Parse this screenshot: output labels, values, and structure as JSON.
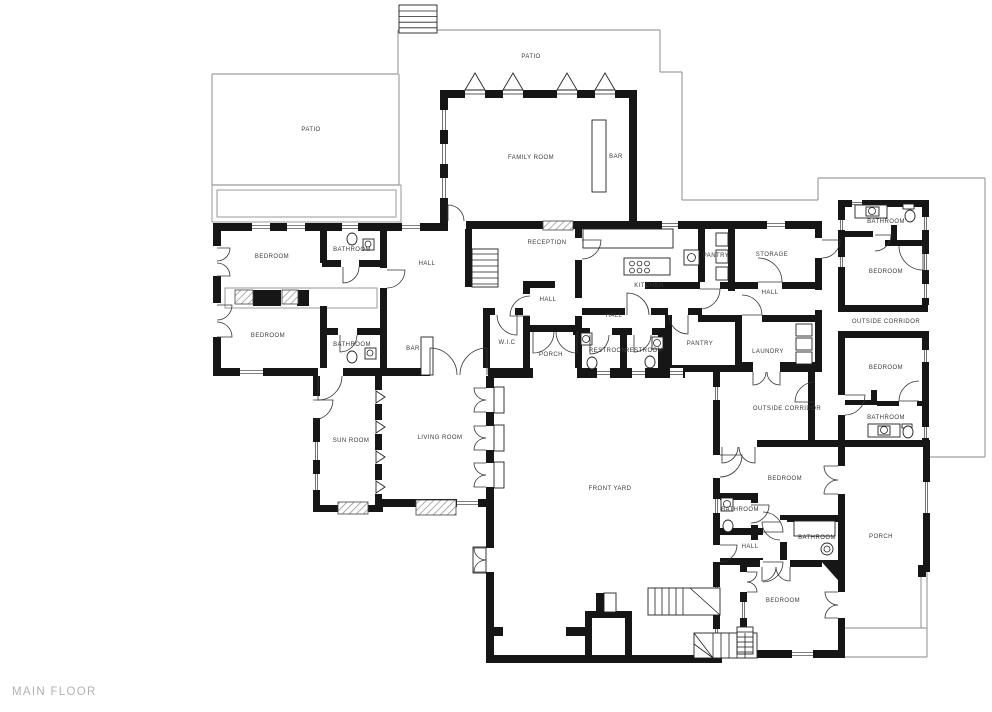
{
  "plan": {
    "title": "MAIN FLOOR",
    "rooms": [
      {
        "label": "PATIO",
        "x": 531,
        "y": 57
      },
      {
        "label": "PATIO",
        "x": 311,
        "y": 130
      },
      {
        "label": "FAMILY ROOM",
        "x": 531,
        "y": 158
      },
      {
        "label": "BAR",
        "x": 616,
        "y": 157
      },
      {
        "label": "BEDROOM",
        "x": 272,
        "y": 257
      },
      {
        "label": "BATHROOM",
        "x": 352,
        "y": 250
      },
      {
        "label": "HALL",
        "x": 427,
        "y": 264
      },
      {
        "label": "RECEPTION",
        "x": 547,
        "y": 243
      },
      {
        "label": "KITCHEN",
        "x": 649,
        "y": 286
      },
      {
        "label": "PANTRY",
        "x": 716,
        "y": 256
      },
      {
        "label": "STORAGE",
        "x": 772,
        "y": 255
      },
      {
        "label": "HALL",
        "x": 770,
        "y": 293
      },
      {
        "label": "BATHROOM",
        "x": 886,
        "y": 222
      },
      {
        "label": "BEDROOM",
        "x": 886,
        "y": 272
      },
      {
        "label": "OUTSIDE CORRIDOR",
        "x": 886,
        "y": 322
      },
      {
        "label": "BEDROOM",
        "x": 268,
        "y": 336
      },
      {
        "label": "BATHROOM",
        "x": 352,
        "y": 345
      },
      {
        "label": "BAR",
        "x": 413,
        "y": 349
      },
      {
        "label": "W.I.C",
        "x": 507,
        "y": 343
      },
      {
        "label": "HALL",
        "x": 548,
        "y": 300
      },
      {
        "label": "HALL",
        "x": 614,
        "y": 316
      },
      {
        "label": "PORCH",
        "x": 551,
        "y": 355
      },
      {
        "label": "RESTROOM",
        "x": 608,
        "y": 351
      },
      {
        "label": "RESTROOM",
        "x": 644,
        "y": 351
      },
      {
        "label": "PANTRY",
        "x": 700,
        "y": 344
      },
      {
        "label": "LAUNDRY",
        "x": 768,
        "y": 352
      },
      {
        "label": "OUTSIDE CORRIDOR",
        "x": 787,
        "y": 409
      },
      {
        "label": "BEDROOM",
        "x": 886,
        "y": 368
      },
      {
        "label": "BATHROOM",
        "x": 886,
        "y": 418
      },
      {
        "label": "SUN ROOM",
        "x": 351,
        "y": 441
      },
      {
        "label": "LIVING ROOM",
        "x": 440,
        "y": 438
      },
      {
        "label": "FRONT YARD",
        "x": 610,
        "y": 489
      },
      {
        "label": "BEDROOM",
        "x": 785,
        "y": 479
      },
      {
        "label": "BATHROOM",
        "x": 740,
        "y": 510
      },
      {
        "label": "BATHROOM",
        "x": 817,
        "y": 538
      },
      {
        "label": "HALL",
        "x": 750,
        "y": 547
      },
      {
        "label": "PORCH",
        "x": 881,
        "y": 537
      },
      {
        "label": "BEDROOM",
        "x": 783,
        "y": 601
      }
    ]
  },
  "colors": {
    "wall": "#161616",
    "boundary": "#9f9f9f",
    "label": "#3a3a3a",
    "title": "#b2b2b2",
    "background": "#ffffff"
  }
}
